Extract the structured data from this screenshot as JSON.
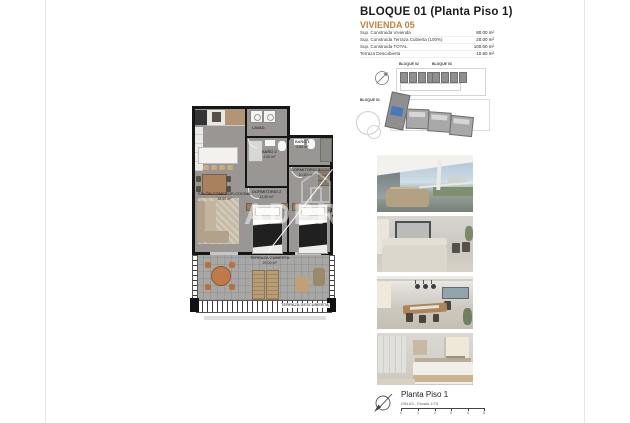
{
  "header": {
    "title": "BLOQUE 01  (Planta Piso 1)",
    "subtitle": "VIVIENDA 05"
  },
  "area_table": {
    "rows": [
      {
        "label": "Sup. Construida Vivienda",
        "value": "80.00 m²"
      },
      {
        "label": "Sup. Construida Terraza Cubierta (100%)",
        "value": "20.00 m²"
      },
      {
        "label": "Sup. Construida TOTAL",
        "value": "100.00 m²"
      },
      {
        "label": "Terraza Descubierta",
        "value": "10.50 m²"
      }
    ]
  },
  "site_plan": {
    "bloque01": "BLOQUE 01",
    "bloque02": "BLOQUE 02",
    "bloque03": "BLOQUE 03",
    "highlight_color": "#4a79b9"
  },
  "floor_plan": {
    "watermark_text": "ADPRO",
    "rooms": {
      "salon": {
        "name": "SALÓN-COMEDOR-COCINA",
        "area": "38.50 m²"
      },
      "dorm1": {
        "name": "DORMITORIO 1",
        "area": "10.50 m²"
      },
      "dorm2": {
        "name": "DORMITORIO 2",
        "area": "11.50 m²"
      },
      "bano1": {
        "name": "BAÑO 1",
        "area": "3.50 m²"
      },
      "bano2": {
        "name": "BAÑO 2",
        "area": "4.00 m²"
      },
      "lavadero": {
        "name": "LAVAD."
      },
      "terraza_cubierta": {
        "name": "TERRAZA CUBIERTA",
        "area": "20.00 m²"
      },
      "terraza_descubierta": {
        "name": "TERRAZA DESCUBIERTA",
        "area": "10.50 m²"
      }
    }
  },
  "footer": {
    "title": "Planta Piso 1",
    "scale_note": "DIN A3 - Escala 1/75",
    "scale_ticks": [
      "0",
      "1",
      "2",
      "3",
      "4",
      "5"
    ]
  },
  "colors": {
    "accent_orange": "#c0813e",
    "highlight_blue": "#4a79b9",
    "wall": "#161616"
  }
}
